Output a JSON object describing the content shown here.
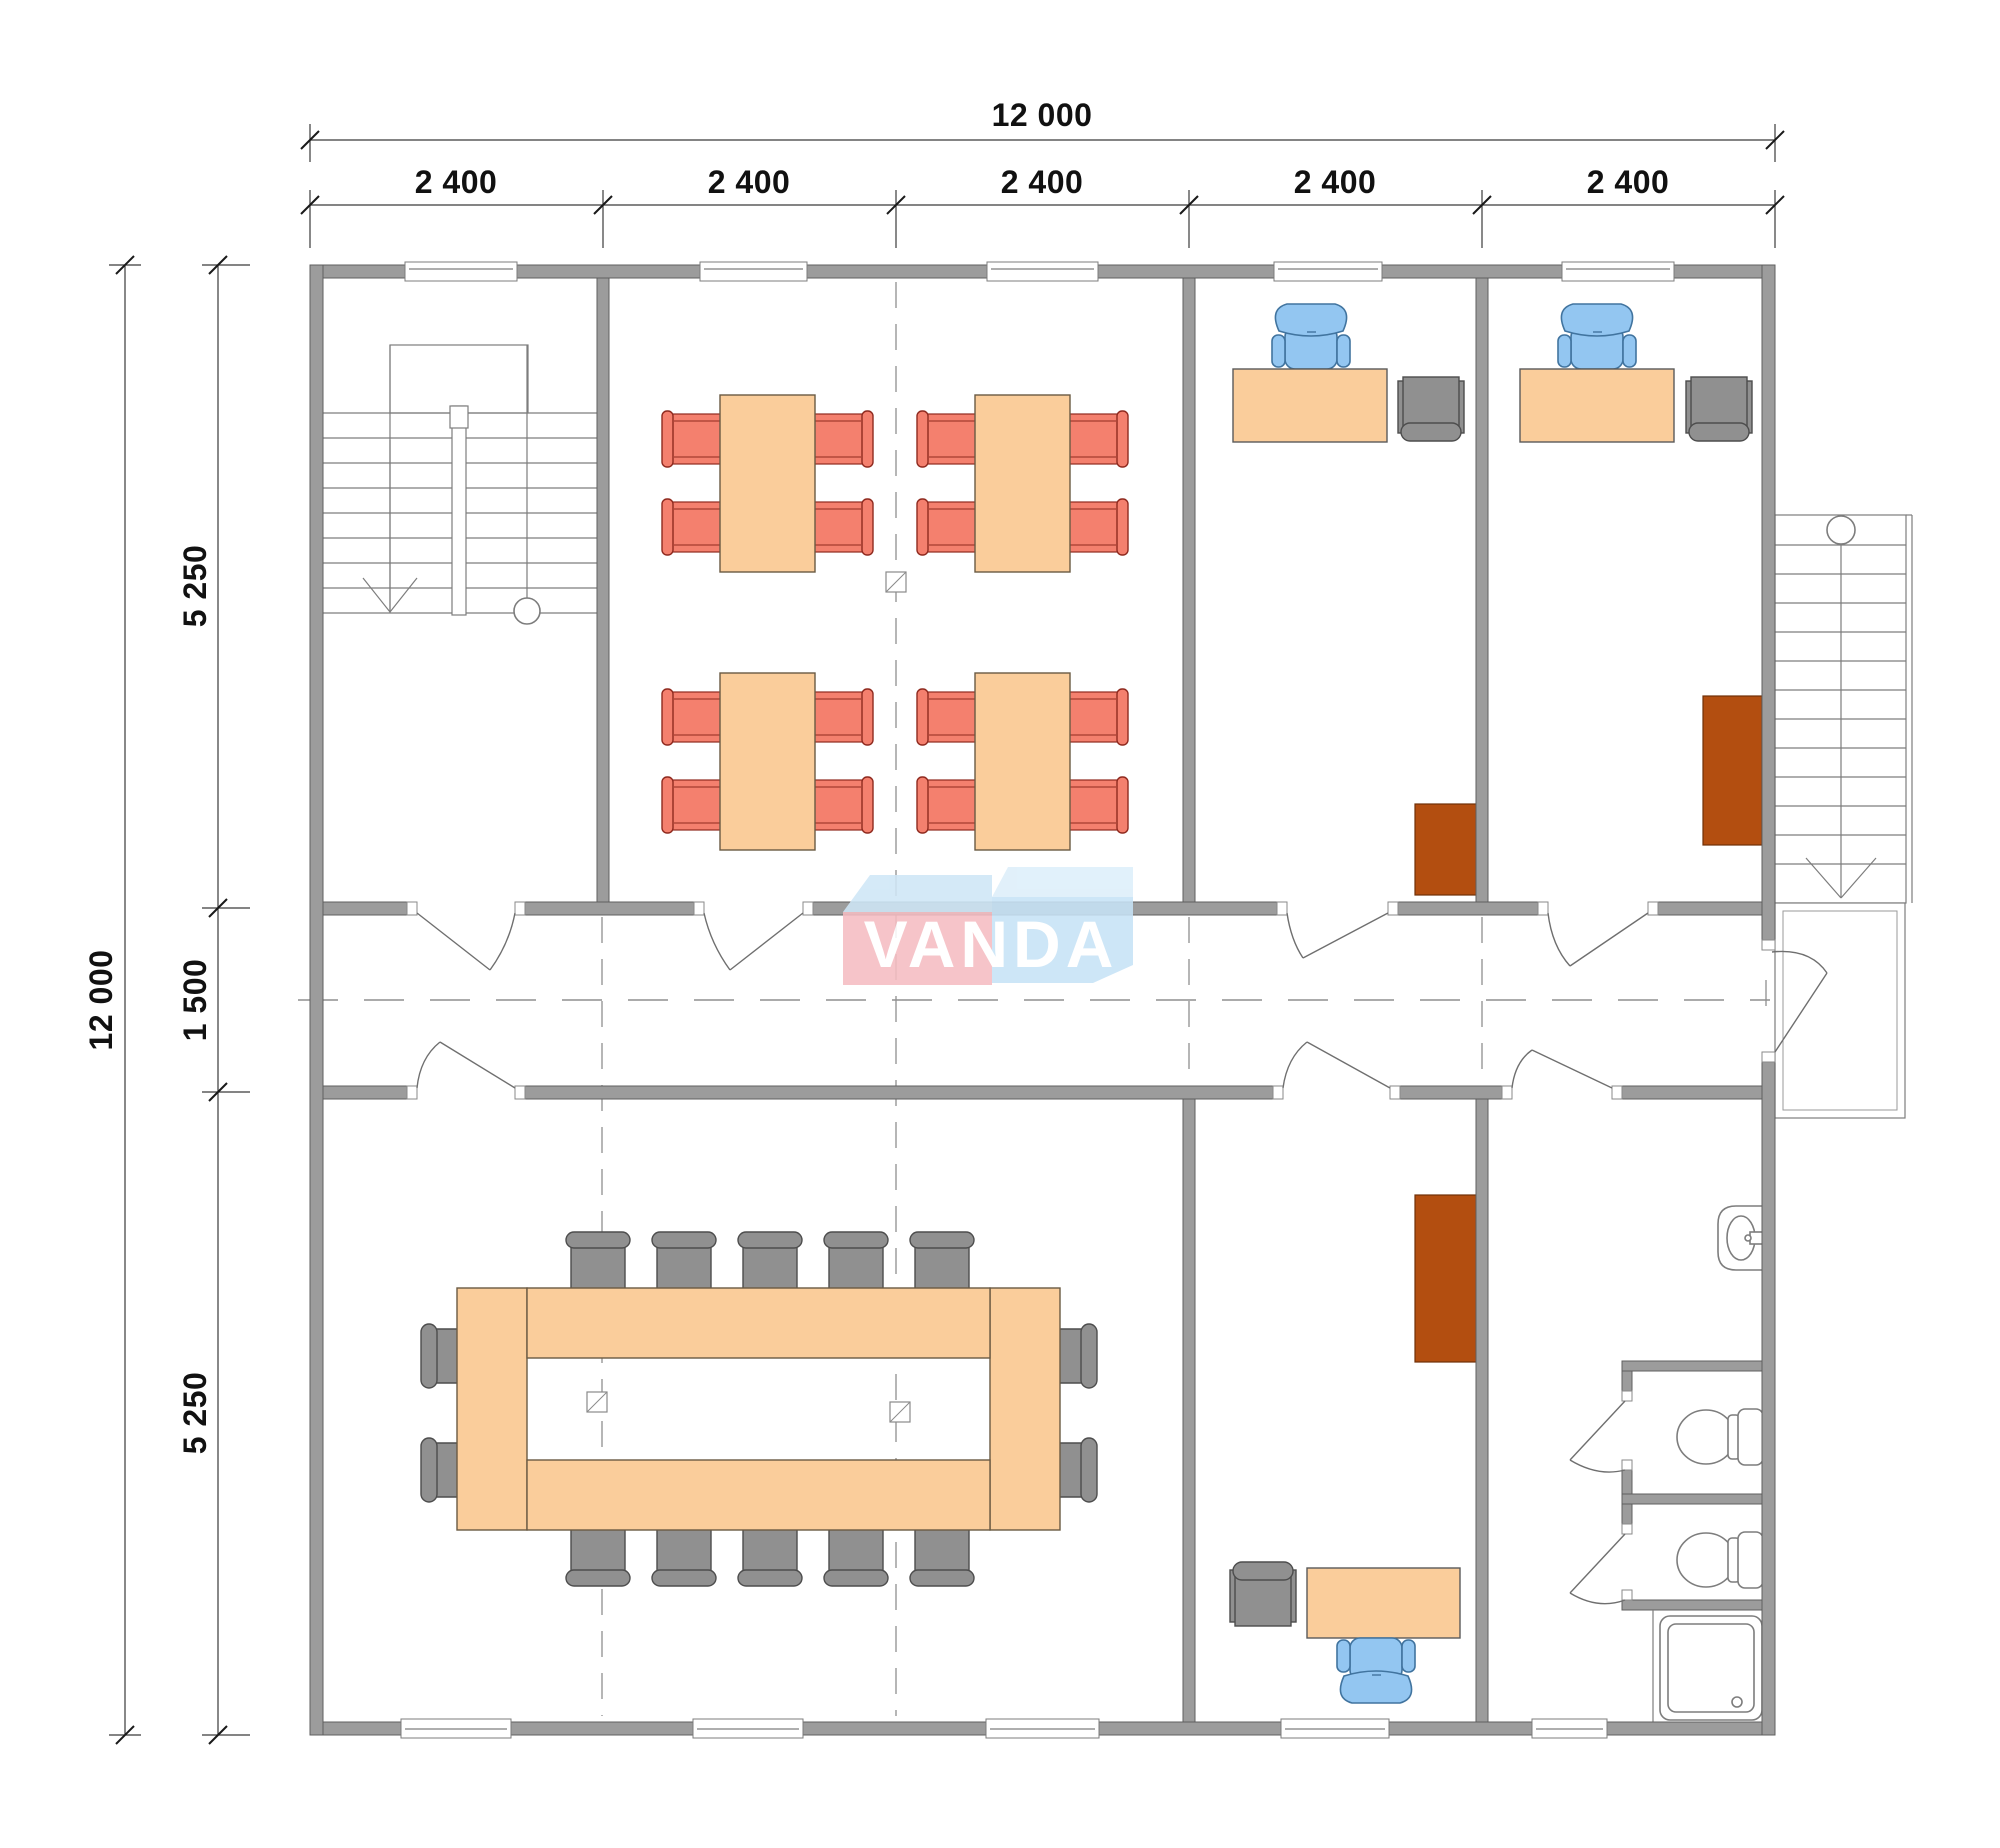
{
  "logo": {
    "text": "VANDA",
    "text_color": "#FFFFFF",
    "pink_box_color": "#F5BDC2",
    "pink_top_face_color": "#CFE7F7",
    "blue_box_color": "#C7E3F6",
    "blue_top_face_color": "#DDEFFA"
  },
  "dimensions": {
    "overall_width": "12 000",
    "width_segments": [
      "2 400",
      "2 400",
      "2 400",
      "2 400",
      "2 400"
    ],
    "overall_height": "12 000",
    "height_segments": [
      "5 250",
      "1 500",
      "5 250"
    ]
  },
  "palette": {
    "wall": "#9C9C9C",
    "wall_stroke": "#5F5F5F",
    "table": "#FACD9B",
    "red_chair": "#F4806E",
    "red_chair_stroke": "#8F2A1F",
    "blue_chair": "#93C6F1",
    "blue_chair_stroke": "#41749F",
    "gray_furniture": "#909090",
    "gray_stroke": "#4D4D4D",
    "cabinet": "#B34E10",
    "cabinet_stroke": "#703008",
    "line": "#7D7D7D"
  },
  "furniture_icons": [
    "classroom-table",
    "classroom-chair",
    "conference-table",
    "conference-chair",
    "office-desk",
    "office-chair",
    "guest-chair",
    "storage-cabinet",
    "toilet-icon",
    "sink-icon",
    "shower-icon",
    "interior-staircase-icon",
    "exterior-staircase-icon",
    "door-swing",
    "window",
    "column-marker"
  ]
}
